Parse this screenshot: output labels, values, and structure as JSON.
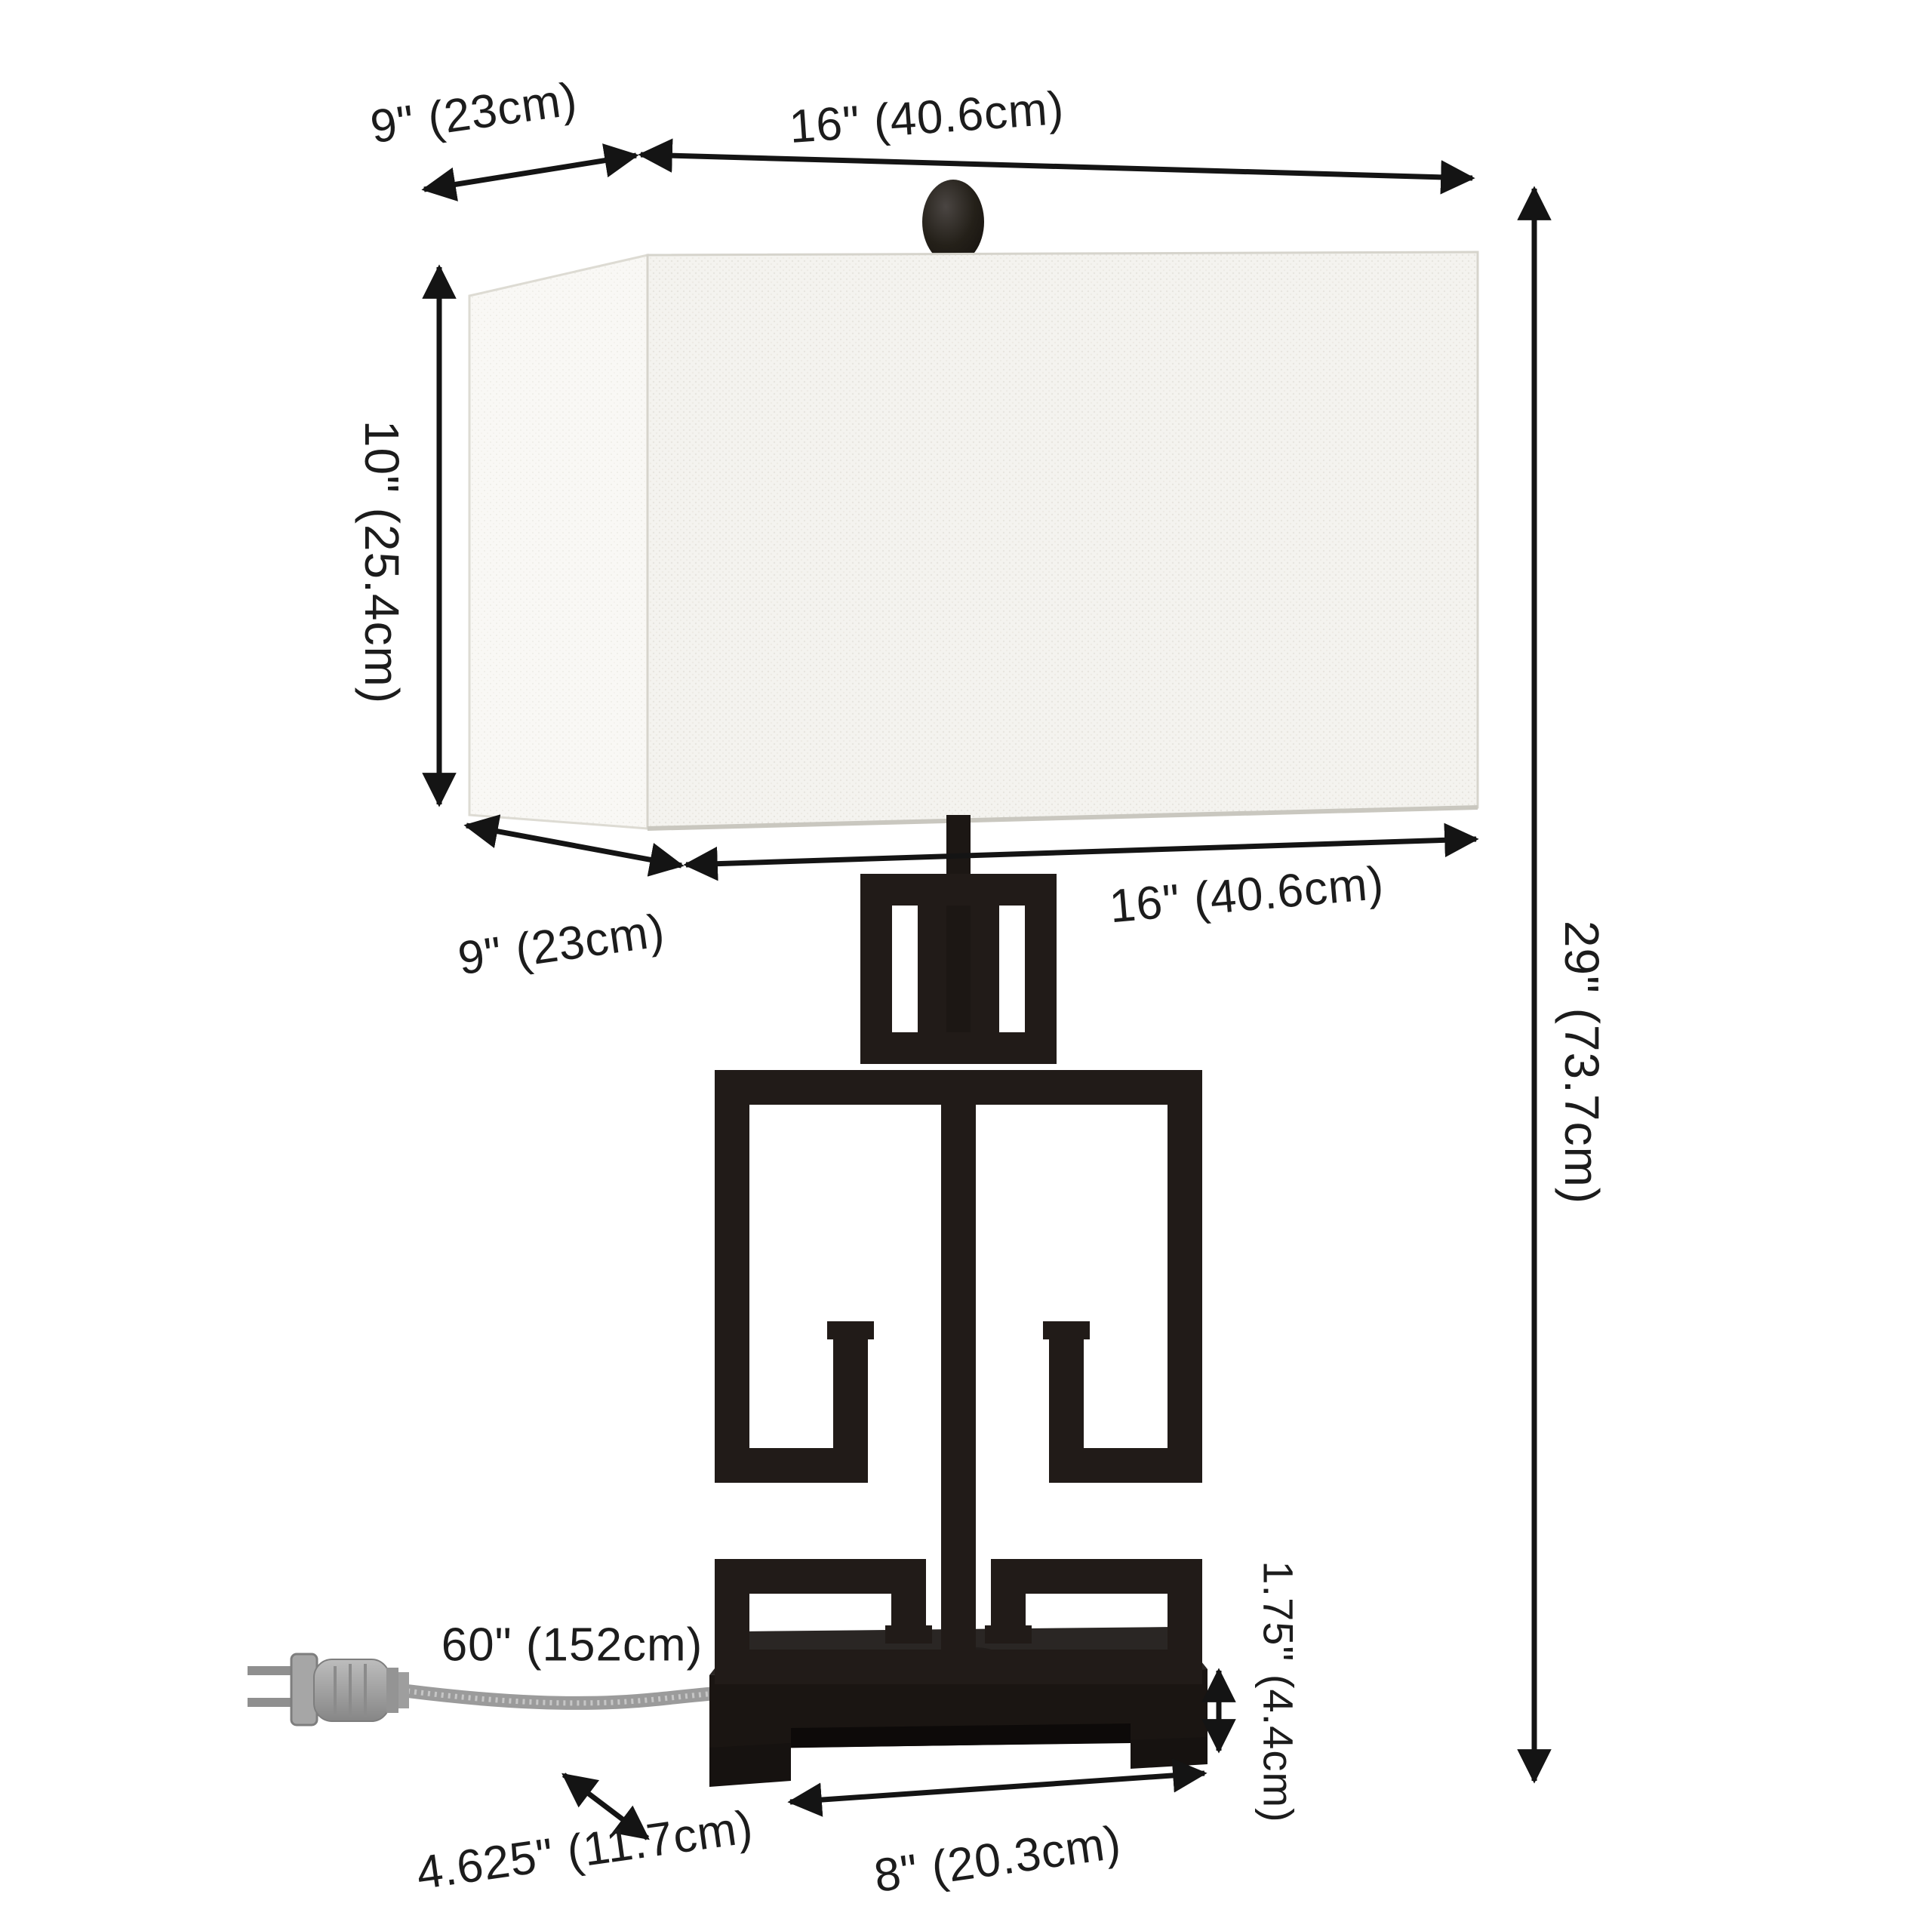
{
  "labels": {
    "shade_top_depth": "9\" (23cm)",
    "shade_top_width": "16\" (40.6cm)",
    "shade_height": "10\" (25.4cm)",
    "shade_bottom_depth": "9\" (23cm)",
    "shade_bottom_width": "16\" (40.6cm)",
    "overall_height": "29\" (73.7cm)",
    "cord_length": "60\" (152cm)",
    "base_depth": "4.625\" (11.7cm)",
    "base_width": "8\" (20.3cm)",
    "base_height": "1.75\" (4.4cm)"
  },
  "colors": {
    "background": "#ffffff",
    "arrow": "#141414",
    "text": "#1c1c1c",
    "lamp_body": "#211b18",
    "base_top": "#2a2624",
    "base_front": "#1a1512",
    "base_recess": "#0d0a09",
    "shade_front": "#f4f3ef",
    "shade_side": "#f9f8f5",
    "shade_edge": "#d6d4cc",
    "cord": "#9b9b9b",
    "plug": "#a6a6a6"
  }
}
